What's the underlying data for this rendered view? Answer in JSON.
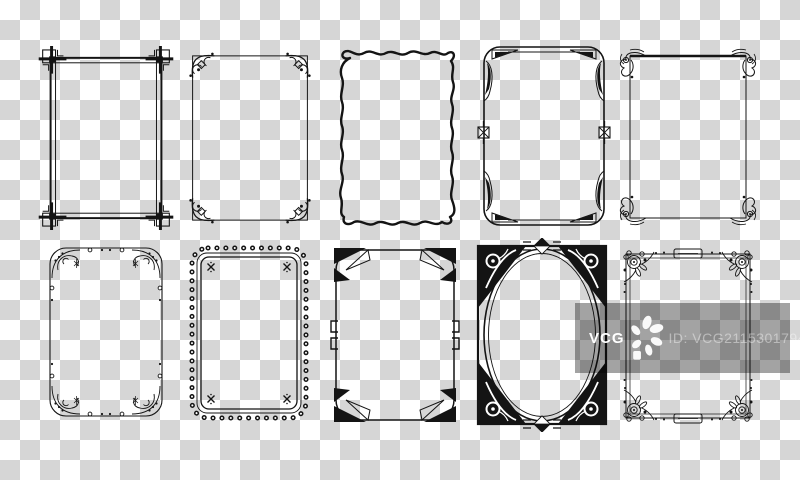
{
  "artboard": {
    "width": 800,
    "height": 480,
    "background": {
      "type": "transparency-checkerboard",
      "square_size_px": 20,
      "light_color": "#ffffff",
      "dark_color": "#d6d6d6"
    },
    "ink_color": "#141414"
  },
  "watermark": {
    "brand": "VCG",
    "id_text": "ID: VCG211530179467",
    "logo_icon": "vcg-flower-logo",
    "band_color": "rgba(0,0,0,0.36)",
    "brand_color": "#ffffff",
    "id_text_color": "rgba(255,255,255,0.42)"
  },
  "frames": [
    {
      "id": "frame-corner-squares",
      "row": 1,
      "col": 1,
      "label": "Double-line frame with interlocking square corner knots"
    },
    {
      "id": "frame-scroll-corners",
      "row": 1,
      "col": 2,
      "label": "Thin frame with curled scroll corners"
    },
    {
      "id": "frame-wavy-line",
      "row": 1,
      "col": 3,
      "label": "Hand-drawn wavy line frame"
    },
    {
      "id": "frame-art-deco",
      "row": 1,
      "col": 4,
      "label": "Art deco rounded frame with arrow corners and crossed squares"
    },
    {
      "id": "frame-filigree",
      "row": 1,
      "col": 5,
      "label": "Thin frame with filigree scroll corners"
    },
    {
      "id": "frame-sprig-beads",
      "row": 2,
      "col": 1,
      "label": "Rounded frame with delicate sprig corners and beads"
    },
    {
      "id": "frame-loop-chain",
      "row": 2,
      "col": 2,
      "label": "Looped chain border frame with corner crosses"
    },
    {
      "id": "frame-nouveau-triangle",
      "row": 2,
      "col": 3,
      "label": "Art nouveau frame with solid triangle corners"
    },
    {
      "id": "frame-oval-knotwork",
      "row": 2,
      "col": 4,
      "label": "Oval frame with knotwork corner panels"
    },
    {
      "id": "frame-floral-rose",
      "row": 2,
      "col": 5,
      "label": "Floral rose frame with blossom corners"
    }
  ]
}
